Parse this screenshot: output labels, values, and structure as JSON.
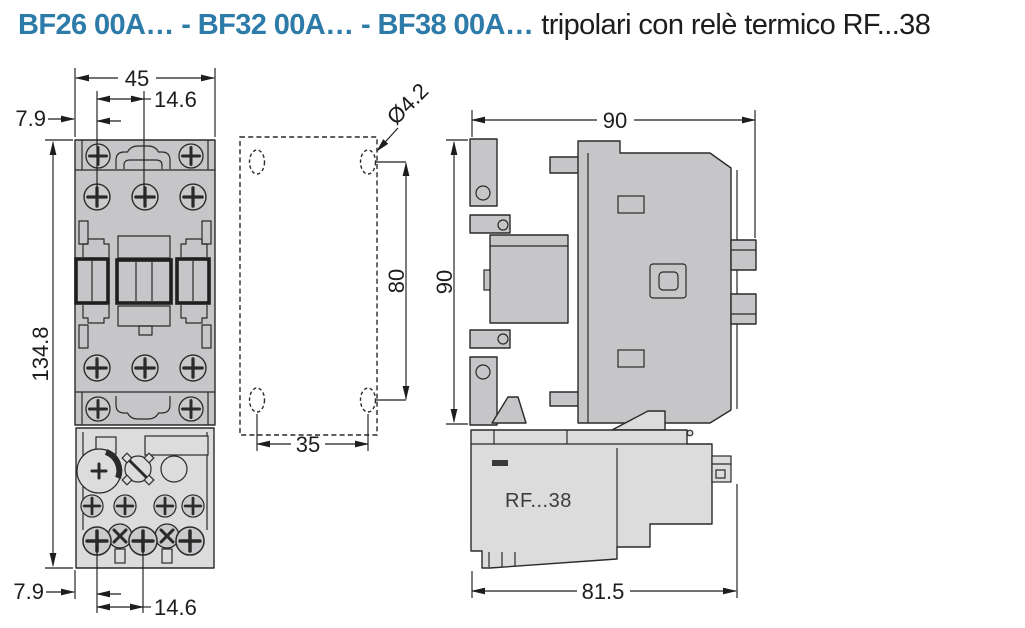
{
  "title": {
    "models": "BF26 00A… - BF32 00A… - BF38 00A…",
    "description": "tripolari con relè termico RF...38"
  },
  "front_view": {
    "dims": {
      "width": "45",
      "hole_spacing_top": "14.6",
      "edge_offset_top": "7.9",
      "total_height": "134.8",
      "edge_offset_bottom": "7.9",
      "hole_spacing_bottom": "14.6"
    }
  },
  "drilling_template": {
    "dims": {
      "hole_diameter": "Ø4.2",
      "vertical_spacing": "80",
      "horizontal_spacing": "35"
    }
  },
  "side_view": {
    "relay_label": "RF...38",
    "dims": {
      "width": "90",
      "height": "90",
      "depth": "81.5"
    }
  },
  "colors": {
    "accent": "#2d7ba9",
    "ink": "#1d1d1b",
    "contactor_fill": "#c6c6c8",
    "relay_fill": "#dcdcdd",
    "line": "#2a2a2a"
  }
}
